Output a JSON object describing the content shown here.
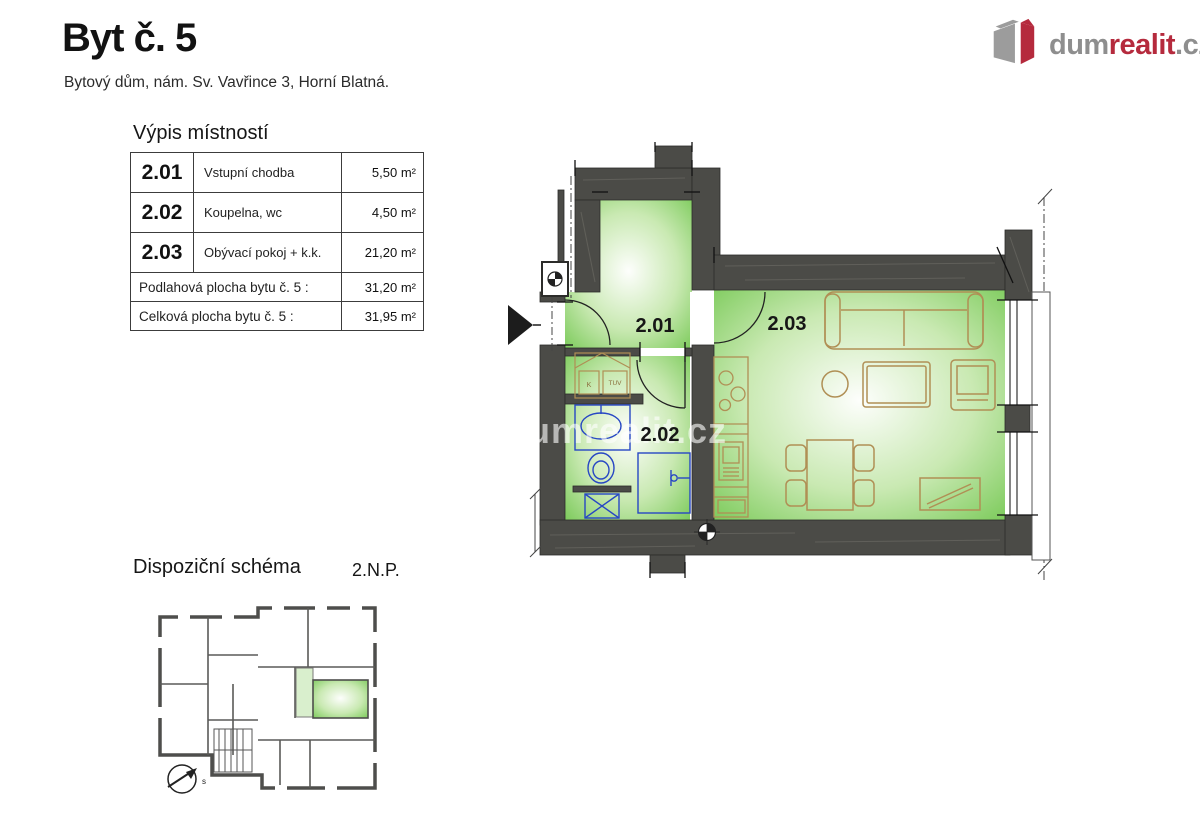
{
  "header": {
    "title": "Byt č. 5",
    "subtitle": "Bytový dům, nám. Sv. Vavřince 3, Horní Blatná."
  },
  "logo": {
    "gray1": "dum",
    "red": "realit",
    "gray2": ".cz"
  },
  "room_table": {
    "title": "Výpis místností",
    "rooms": [
      {
        "number": "2.01",
        "name": "Vstupní chodba",
        "area": "5,50 m²"
      },
      {
        "number": "2.02",
        "name": "Koupelna, wc",
        "area": "4,50 m²"
      },
      {
        "number": "2.03",
        "name": "Obývací pokoj + k.k.",
        "area": "21,20 m²"
      }
    ],
    "summary": [
      {
        "label": "Podlahová plocha bytu  č. 5 :",
        "area": "31,20 m²"
      },
      {
        "label": "Celková plocha bytu  č. 5 :",
        "area": "31,95 m²"
      }
    ]
  },
  "floor_plan": {
    "labels": {
      "room1": "2.01",
      "room2": "2.02",
      "room3": "2.03"
    },
    "closet": {
      "tuv": "TUV",
      "k": "K"
    },
    "watermark": "dumrealit.cz"
  },
  "schematic": {
    "title": "Dispoziční schéma",
    "floor": "2.N.P.",
    "compass": "s"
  },
  "colors": {
    "wall": "#4b4b47",
    "room_green": "#7dcb5c",
    "fixture_blue": "#2747c4",
    "furniture_tan": "#b08f55",
    "logo_red": "#b52a3d",
    "logo_gray": "#8e8e8e"
  }
}
